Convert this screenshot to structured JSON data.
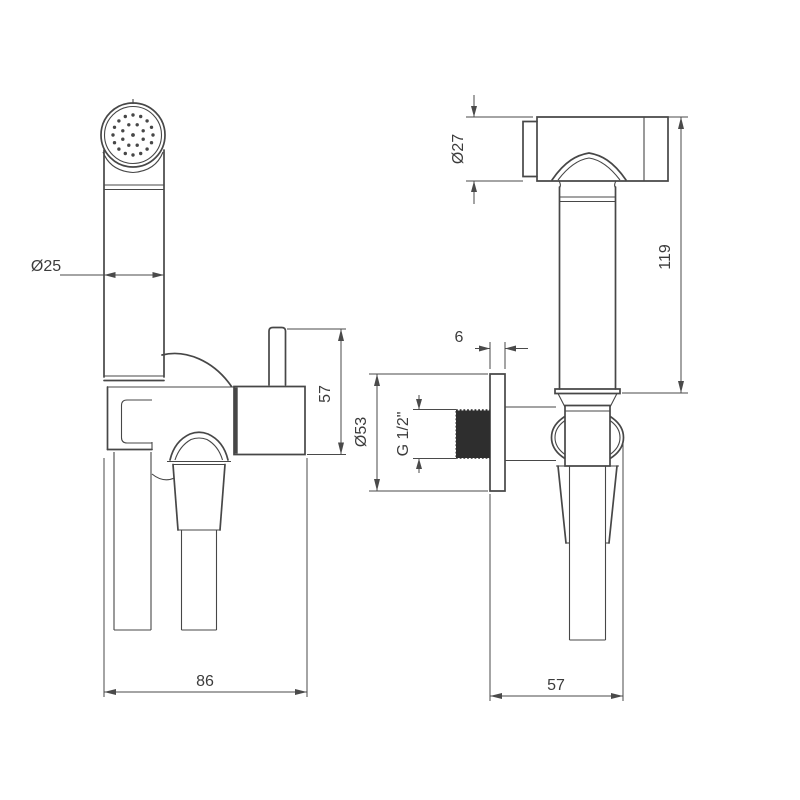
{
  "page": {
    "background": "#ffffff"
  },
  "drawing": {
    "line_color": "#474747",
    "dim_color": "#4a4a4a",
    "text_color": "#3c3c3c",
    "front_view": {
      "dims": {
        "handle_diameter": "Ø25",
        "valve_height": "57",
        "overall_width": "86"
      }
    },
    "side_view": {
      "dims": {
        "head_diameter": "Ø27",
        "body_height": "119",
        "plate_thickness": "6",
        "plate_diameter": "Ø53",
        "thread_size": "G 1/2\"",
        "overall_depth": "57"
      }
    }
  }
}
